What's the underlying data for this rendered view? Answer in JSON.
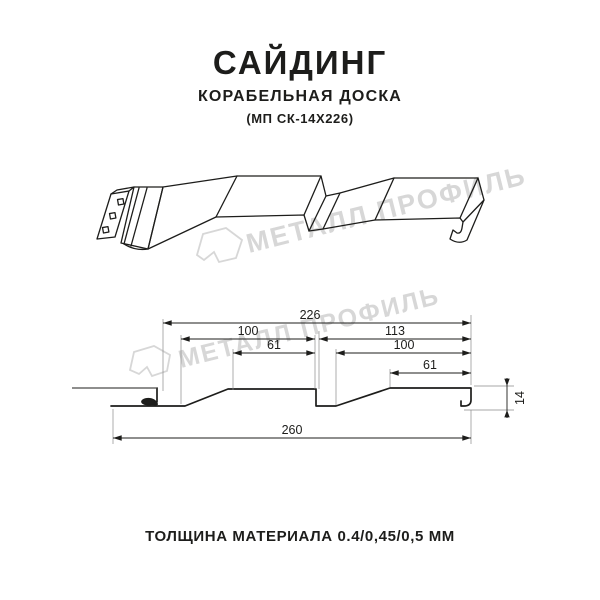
{
  "header": {
    "title": "САЙДИНГ",
    "subtitle": "КОРАБЕЛЬНАЯ ДОСКА",
    "code": "(МП СК-14Х226)"
  },
  "watermark": {
    "brand": "МЕТАЛЛ ПРОФИЛЬ",
    "color": "#d7d7d7"
  },
  "cross_section": {
    "dims": {
      "top_total": "226",
      "left_upper": "100",
      "left_inner": "61",
      "right_upper": "113",
      "right_mid": "100",
      "right_inner": "61",
      "height": "14",
      "bottom_total": "260"
    }
  },
  "footer": {
    "thickness": "ТОЛЩИНА МАТЕРИАЛА 0.4/0,45/0,5 ММ"
  }
}
